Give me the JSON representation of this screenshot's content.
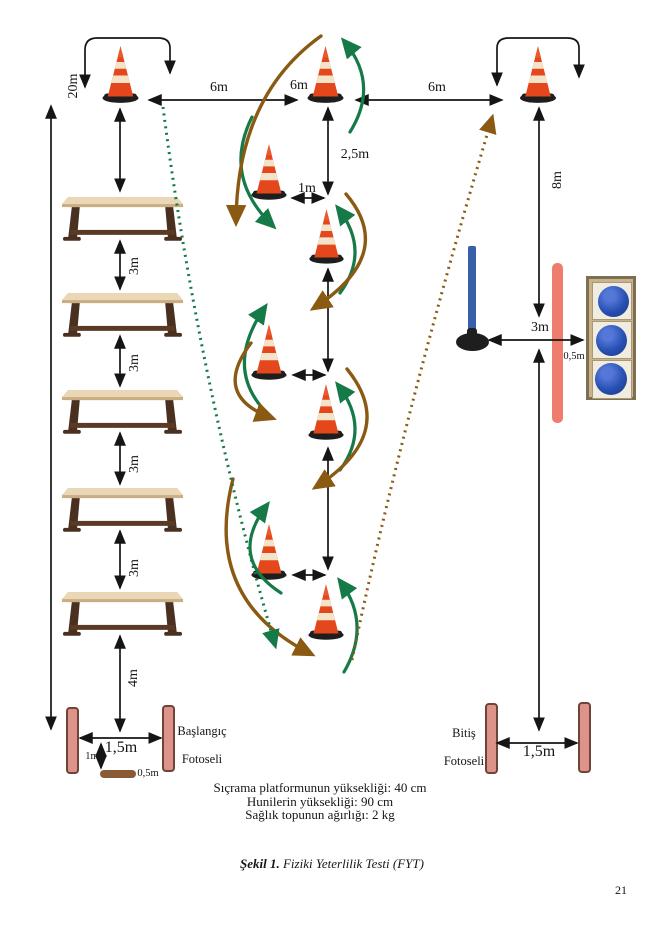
{
  "figure": {
    "caption_bold": "Şekil 1.",
    "caption_italic": " Fiziki Yeterlilik Testi (FYT)",
    "page_number": "21",
    "notes": [
      "Sıçrama platformunun yüksekliği: 40 cm",
      "Hunilerin yüksekliği: 90 cm",
      "Sağlık topunun ağırlığı: 2 kg"
    ]
  },
  "stations": {
    "start": {
      "line1": "Başlangıç",
      "line2": "Fotoseli"
    },
    "finish": {
      "line1": "Bitiş",
      "line2": "Fotoseli"
    }
  },
  "measurements": {
    "total_left": "20m",
    "gap_6m_left": "6m",
    "gap_6m_mid": "6m",
    "gap_6m_right": "6m",
    "slalom_vertical": "2,5m",
    "slalom_offset_top": "1m",
    "right_vertical": "8m",
    "hurdle_gap_1": "3m",
    "hurdle_gap_2": "3m",
    "hurdle_gap_3": "3m",
    "hurdle_gap_4": "3m",
    "hurdle_to_start": "4m",
    "ball_line": "3m",
    "ball_bar_gap": "0,5m",
    "start_gate_width": "1,5m",
    "platform_distance": "1m",
    "platform_width": "0,5m",
    "finish_gate_width": "1,5m"
  },
  "colors": {
    "cone_orange": "#e4471b",
    "cone_stripe": "#f2e3c9",
    "cone_base": "#1e1e1e",
    "arrow_black": "#151515",
    "arrow_green": "#157a47",
    "arrow_brown": "#8a5a13",
    "photocell_fill": "#dd938a",
    "photocell_border": "#6e4438",
    "platform_brown": "#8a5a36",
    "pole_blue": "#3660a8",
    "ball_blue": "#2850b4",
    "box_tan": "#c9b38c",
    "bar_pink": "#ee7d6d",
    "hurdle_top": "#ddc6a2",
    "hurdle_frame": "#4a3020"
  }
}
